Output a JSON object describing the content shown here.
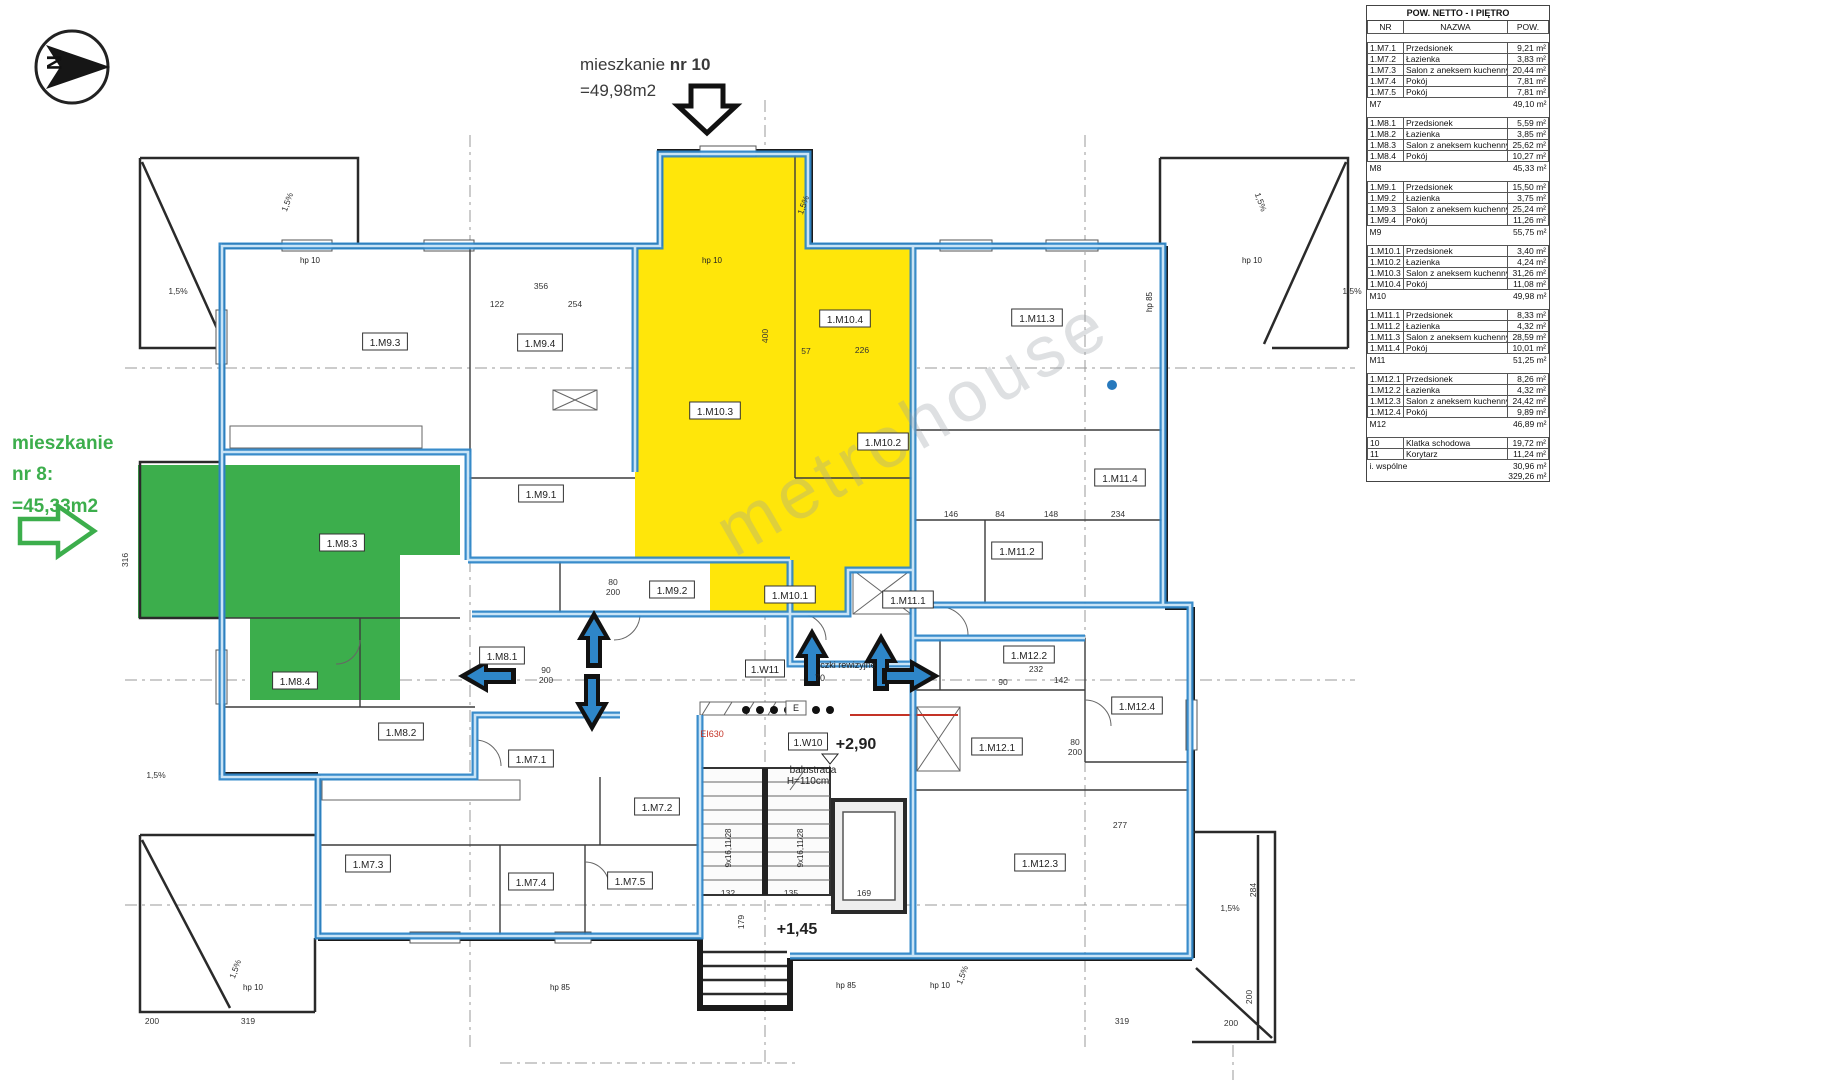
{
  "annotations": {
    "apartment10": {
      "prefix": "mieszkanie ",
      "number": "nr 10",
      "area": "=49,98m2"
    },
    "apartment8": {
      "line1": "mieszkanie",
      "line2": "nr 8:",
      "line3": "=45,33m2"
    },
    "compass_letter": "N",
    "watermark": "metrohouse"
  },
  "colors": {
    "apartment8_green": "#3cae4c",
    "apartment10_yellow": "#ffe60a",
    "boundary_blue": "#2e86c8",
    "fire_rating_red": "#c43326"
  },
  "plan": {
    "room_labels": [
      {
        "text": "1.M9.3",
        "x": 385,
        "y": 342
      },
      {
        "text": "1.M9.4",
        "x": 540,
        "y": 343
      },
      {
        "text": "1.M9.1",
        "x": 541,
        "y": 494
      },
      {
        "text": "1.M9.2",
        "x": 672,
        "y": 590
      },
      {
        "text": "1.M10.3",
        "x": 715,
        "y": 411
      },
      {
        "text": "1.M10.4",
        "x": 845,
        "y": 319
      },
      {
        "text": "1.M10.2",
        "x": 883,
        "y": 442
      },
      {
        "text": "1.M10.1",
        "x": 790,
        "y": 595
      },
      {
        "text": "1.M11.3",
        "x": 1037,
        "y": 318
      },
      {
        "text": "1.M11.4",
        "x": 1120,
        "y": 478
      },
      {
        "text": "1.M11.2",
        "x": 1017,
        "y": 551
      },
      {
        "text": "1.M11.1",
        "x": 908,
        "y": 600
      },
      {
        "text": "1.M12.2",
        "x": 1029,
        "y": 655
      },
      {
        "text": "1.M12.4",
        "x": 1137,
        "y": 706
      },
      {
        "text": "1.M12.1",
        "x": 997,
        "y": 747
      },
      {
        "text": "1.M12.3",
        "x": 1040,
        "y": 863
      },
      {
        "text": "1.M8.3",
        "x": 342,
        "y": 543
      },
      {
        "text": "1.M8.4",
        "x": 295,
        "y": 681
      },
      {
        "text": "1.M8.2",
        "x": 401,
        "y": 732
      },
      {
        "text": "1.M8.1",
        "x": 502,
        "y": 656
      },
      {
        "text": "1.M7.1",
        "x": 531,
        "y": 759
      },
      {
        "text": "1.M7.2",
        "x": 657,
        "y": 807
      },
      {
        "text": "1.M7.3",
        "x": 368,
        "y": 864
      },
      {
        "text": "1.M7.4",
        "x": 531,
        "y": 882
      },
      {
        "text": "1.M7.5",
        "x": 630,
        "y": 881
      },
      {
        "text": "1.W11",
        "x": 765,
        "y": 669
      },
      {
        "text": "1.W10",
        "x": 808,
        "y": 742
      }
    ],
    "dim_labels": [
      {
        "t": "356",
        "x": 541,
        "y": 289
      },
      {
        "t": "122",
        "x": 497,
        "y": 307
      },
      {
        "t": "254",
        "x": 575,
        "y": 307
      },
      {
        "t": "400",
        "x": 768,
        "y": 336,
        "r": -90
      },
      {
        "t": "57",
        "x": 806,
        "y": 354
      },
      {
        "t": "226",
        "x": 862,
        "y": 353
      },
      {
        "t": "146",
        "x": 951,
        "y": 517
      },
      {
        "t": "84",
        "x": 1000,
        "y": 517
      },
      {
        "t": "148",
        "x": 1051,
        "y": 517
      },
      {
        "t": "234",
        "x": 1118,
        "y": 517
      },
      {
        "t": "232",
        "x": 1036,
        "y": 672
      },
      {
        "t": "90",
        "x": 1003,
        "y": 685
      },
      {
        "t": "142",
        "x": 1061,
        "y": 683
      },
      {
        "t": "277",
        "x": 1120,
        "y": 828
      },
      {
        "t": "316",
        "x": 128,
        "y": 560,
        "r": -90
      },
      {
        "t": "319",
        "x": 248,
        "y": 1024
      },
      {
        "t": "200",
        "x": 152,
        "y": 1024
      },
      {
        "t": "319",
        "x": 1122,
        "y": 1024
      },
      {
        "t": "200",
        "x": 1231,
        "y": 1026
      },
      {
        "t": "132",
        "x": 728,
        "y": 896
      },
      {
        "t": "135",
        "x": 791,
        "y": 896
      },
      {
        "t": "169",
        "x": 864,
        "y": 896
      },
      {
        "t": "179",
        "x": 744,
        "y": 922,
        "r": -90
      },
      {
        "t": "284",
        "x": 1256,
        "y": 890,
        "r": -90
      },
      {
        "t": "200",
        "x": 1252,
        "y": 997,
        "r": -90
      },
      {
        "t": "90",
        "x": 546,
        "y": 673
      },
      {
        "t": "200",
        "x": 546,
        "y": 683
      },
      {
        "t": "80",
        "x": 613,
        "y": 585
      },
      {
        "t": "200",
        "x": 613,
        "y": 595
      },
      {
        "t": "80",
        "x": 1075,
        "y": 745
      },
      {
        "t": "200",
        "x": 1075,
        "y": 755
      },
      {
        "t": "1,5%",
        "x": 290,
        "y": 203,
        "r": -70
      },
      {
        "t": "1,5%",
        "x": 178,
        "y": 294
      },
      {
        "t": "1,5%",
        "x": 806,
        "y": 206,
        "r": -70
      },
      {
        "t": "1,5%",
        "x": 1258,
        "y": 203,
        "r": 70
      },
      {
        "t": "1,5%",
        "x": 1352,
        "y": 294
      },
      {
        "t": "1,5%",
        "x": 156,
        "y": 778
      },
      {
        "t": "1,5%",
        "x": 238,
        "y": 970,
        "r": -70
      },
      {
        "t": "1,5%",
        "x": 1230,
        "y": 911
      },
      {
        "t": "1,5%",
        "x": 965,
        "y": 976,
        "r": -70
      }
    ],
    "notes": [
      {
        "t": "+2,90",
        "x": 856,
        "y": 749,
        "s": 16,
        "b": true
      },
      {
        "t": "+1,45",
        "x": 797,
        "y": 934,
        "s": 16,
        "b": true
      },
      {
        "t": "balustrada",
        "x": 813,
        "y": 773,
        "s": 10
      },
      {
        "t": "H=110cm",
        "x": 808,
        "y": 784,
        "s": 10
      },
      {
        "t": "EI630",
        "x": 712,
        "y": 737,
        "s": 9,
        "c": "#c43326"
      },
      {
        "t": "czki rewizyjne",
        "x": 848,
        "y": 668,
        "s": 9
      },
      {
        "t": "70",
        "x": 820,
        "y": 681,
        "s": 9
      },
      {
        "t": "E",
        "x": 796,
        "y": 711,
        "s": 9
      },
      {
        "t": "9x16,11/28",
        "x": 731,
        "y": 848,
        "s": 8,
        "r": -90
      },
      {
        "t": "9x16,11/28",
        "x": 803,
        "y": 848,
        "s": 8,
        "r": -90
      },
      {
        "t": "hp 10",
        "x": 310,
        "y": 263,
        "s": 8
      },
      {
        "t": "hp 10",
        "x": 712,
        "y": 263,
        "s": 8
      },
      {
        "t": "hp 10",
        "x": 1252,
        "y": 263,
        "s": 8
      },
      {
        "t": "hp 85",
        "x": 1152,
        "y": 302,
        "s": 8,
        "r": -90
      },
      {
        "t": "hp 10",
        "x": 253,
        "y": 990,
        "s": 8
      },
      {
        "t": "hp 85",
        "x": 560,
        "y": 990,
        "s": 8
      },
      {
        "t": "hp 85",
        "x": 846,
        "y": 988,
        "s": 8
      },
      {
        "t": "hp 10",
        "x": 940,
        "y": 988,
        "s": 8
      }
    ]
  },
  "table": {
    "title": "POW. NETTO - I PIĘTRO",
    "columns": [
      "NR",
      "NAZWA",
      "POW."
    ],
    "rows": [
      {
        "t": "title"
      },
      {
        "t": "cols"
      },
      {
        "t": "spacer"
      },
      {
        "t": "item",
        "nr": "1.M7.1",
        "nazwa": "Przedsionek",
        "pow": "9,21 m²"
      },
      {
        "t": "item",
        "nr": "1.M7.2",
        "nazwa": "Łazienka",
        "pow": "3,83 m²"
      },
      {
        "t": "item",
        "nr": "1.M7.3",
        "nazwa": "Salon z aneksem kuchennym",
        "pow": "20,44 m²"
      },
      {
        "t": "item",
        "nr": "1.M7.4",
        "nazwa": "Pokój",
        "pow": "7,81 m²"
      },
      {
        "t": "item",
        "nr": "1.M7.5",
        "nazwa": "Pokój",
        "pow": "7,81 m²"
      },
      {
        "t": "sum",
        "nr": "M7",
        "pow": "49,10 m²"
      },
      {
        "t": "spacer"
      },
      {
        "t": "item",
        "nr": "1.M8.1",
        "nazwa": "Przedsionek",
        "pow": "5,59 m²"
      },
      {
        "t": "item",
        "nr": "1.M8.2",
        "nazwa": "Łazienka",
        "pow": "3,85 m²"
      },
      {
        "t": "item",
        "nr": "1.M8.3",
        "nazwa": "Salon z aneksem kuchennym",
        "pow": "25,62 m²"
      },
      {
        "t": "item",
        "nr": "1.M8.4",
        "nazwa": "Pokój",
        "pow": "10,27 m²"
      },
      {
        "t": "sum",
        "nr": "M8",
        "pow": "45,33 m²"
      },
      {
        "t": "spacer"
      },
      {
        "t": "item",
        "nr": "1.M9.1",
        "nazwa": "Przedsionek",
        "pow": "15,50 m²"
      },
      {
        "t": "item",
        "nr": "1.M9.2",
        "nazwa": "Łazienka",
        "pow": "3,75 m²"
      },
      {
        "t": "item",
        "nr": "1.M9.3",
        "nazwa": "Salon z aneksem kuchennym",
        "pow": "25,24 m²"
      },
      {
        "t": "item",
        "nr": "1.M9.4",
        "nazwa": "Pokój",
        "pow": "11,26 m²"
      },
      {
        "t": "sum",
        "nr": "M9",
        "pow": "55,75 m²"
      },
      {
        "t": "spacer"
      },
      {
        "t": "item",
        "nr": "1.M10.1",
        "nazwa": "Przedsionek",
        "pow": "3,40 m²"
      },
      {
        "t": "item",
        "nr": "1.M10.2",
        "nazwa": "Łazienka",
        "pow": "4,24 m²"
      },
      {
        "t": "item",
        "nr": "1.M10.3",
        "nazwa": "Salon z aneksem kuchennym",
        "pow": "31,26 m²"
      },
      {
        "t": "item",
        "nr": "1.M10.4",
        "nazwa": "Pokój",
        "pow": "11,08 m²"
      },
      {
        "t": "sum",
        "nr": "M10",
        "pow": "49,98 m²"
      },
      {
        "t": "spacer"
      },
      {
        "t": "item",
        "nr": "1.M11.1",
        "nazwa": "Przedsionek",
        "pow": "8,33 m²"
      },
      {
        "t": "item",
        "nr": "1.M11.2",
        "nazwa": "Łazienka",
        "pow": "4,32 m²"
      },
      {
        "t": "item",
        "nr": "1.M11.3",
        "nazwa": "Salon z aneksem kuchennym",
        "pow": "28,59 m²"
      },
      {
        "t": "item",
        "nr": "1.M11.4",
        "nazwa": "Pokój",
        "pow": "10,01 m²"
      },
      {
        "t": "sum",
        "nr": "M11",
        "pow": "51,25 m²"
      },
      {
        "t": "spacer"
      },
      {
        "t": "item",
        "nr": "1.M12.1",
        "nazwa": "Przedsionek",
        "pow": "8,26 m²"
      },
      {
        "t": "item",
        "nr": "1.M12.2",
        "nazwa": "Łazienka",
        "pow": "4,32 m²"
      },
      {
        "t": "item",
        "nr": "1.M12.3",
        "nazwa": "Salon z aneksem kuchennym",
        "pow": "24,42 m²"
      },
      {
        "t": "item",
        "nr": "1.M12.4",
        "nazwa": "Pokój",
        "pow": "9,89 m²"
      },
      {
        "t": "sum",
        "nr": "M12",
        "pow": "46,89 m²"
      },
      {
        "t": "spacer"
      },
      {
        "t": "item",
        "nr": "10",
        "nazwa": "Klatka schodowa",
        "pow": "19,72 m²"
      },
      {
        "t": "item",
        "nr": "11",
        "nazwa": "Korytarz",
        "pow": "11,24 m²"
      },
      {
        "t": "sum",
        "nr": "i. wspólne",
        "pow": "30,96 m²"
      },
      {
        "t": "total",
        "pow": "329,26 m²"
      }
    ]
  }
}
